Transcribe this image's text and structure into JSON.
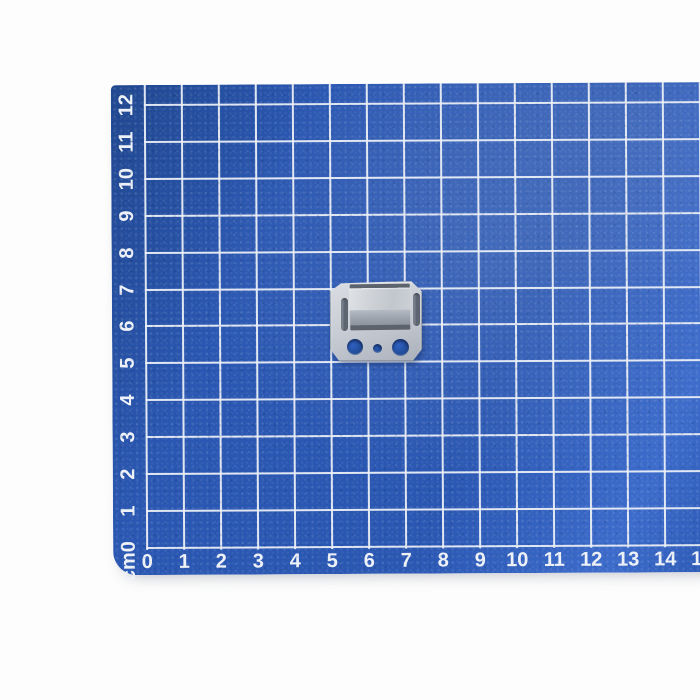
{
  "photo": {
    "subject": "Galvanized steel clip lying on a blue centimeter grid measuring mat",
    "background_color": "#fdfdfd"
  },
  "mat": {
    "unit_corner_label": "cm0",
    "x_axis_labels": [
      "0",
      "1",
      "2",
      "3",
      "4",
      "5",
      "6",
      "7",
      "8",
      "9",
      "10",
      "11",
      "12",
      "13",
      "14",
      "15"
    ],
    "y_axis_labels": [
      "1",
      "2",
      "3",
      "4",
      "5",
      "6",
      "7",
      "8",
      "9",
      "10",
      "11",
      "12"
    ],
    "colors": {
      "surface": "#2a57b2",
      "surface_light": "#3c6bcb",
      "surface_dark": "#20478f",
      "grid_line": "#eaeef6",
      "label_text": "#eef2f8"
    }
  },
  "clip_part": {
    "name": "galvanized metal clip",
    "colors": {
      "plate": "#c7ccd4",
      "plate_light": "#dadde2",
      "plate_dark": "#aab0ba",
      "fold_shadow": "#5c636c",
      "face_top": "#b5bbc3",
      "face_bottom": "#8a929c",
      "slot": "#59616f",
      "hole_fill": "#1e478f"
    }
  }
}
